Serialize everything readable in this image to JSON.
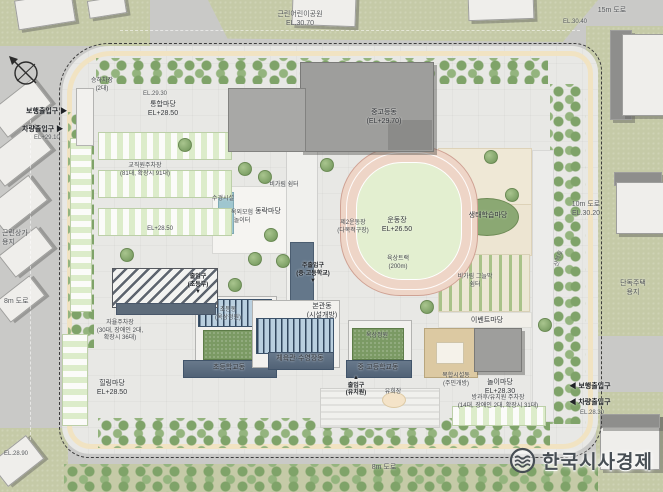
{
  "watermark": {
    "text": "한국시사경제",
    "icon": "waves-logo-icon",
    "color": "#474e54"
  },
  "compass": {
    "icon": "north-arrow-icon"
  },
  "palette": {
    "road": "#c9c9c7",
    "context_green": "#c5caa7",
    "site_paving": "#e8e8e5",
    "perimeter_path": "#f1e3c0",
    "track_ring": "#eed5c7",
    "track_infield": "#e3efd0",
    "pv_roof": "#b9cfdf",
    "building_band": "#5d6e80",
    "green_roof": "#7b9a64",
    "gym_gray": "#9e9e9c",
    "parking_green": "#dcecca",
    "boundary": "#3c3c3c"
  },
  "labels": [
    {
      "id": "neighborhood-park",
      "t": "근린어린이공원\nEL.30.70",
      "x": 300,
      "y": 11,
      "cls": "ctx"
    },
    {
      "id": "road-15m",
      "t": "15m 도로",
      "x": 612,
      "y": 7,
      "cls": "ctx"
    },
    {
      "id": "el-30-40",
      "t": "EL.30.40",
      "x": 575,
      "y": 19,
      "cls": "ctx tiny"
    },
    {
      "id": "el-29-30",
      "t": "EL.29.30",
      "x": 155,
      "y": 91,
      "cls": "ctx tiny"
    },
    {
      "id": "ped-entrance-west",
      "t": "보행출입구 ▶",
      "x": 26,
      "y": 108,
      "cls": "left b"
    },
    {
      "id": "veh-entrance-west",
      "t": "차량출입구 ▶",
      "x": 22,
      "y": 126,
      "cls": "left b"
    },
    {
      "id": "el-29-10",
      "t": "EL+29.10",
      "x": 34,
      "y": 135,
      "cls": "left tiny ctx"
    },
    {
      "id": "retail-site",
      "t": "근린상가\n용지",
      "x": 2,
      "y": 230,
      "cls": "left ctx"
    },
    {
      "id": "road-8m-west",
      "t": "8m 도로",
      "x": 4,
      "y": 298,
      "cls": "left ctx"
    },
    {
      "id": "road-10m-east",
      "t": "10m 도로\nEL.30.20",
      "x": 586,
      "y": 201,
      "cls": "ctx"
    },
    {
      "id": "walking-path",
      "t": "산책로",
      "x": 560,
      "y": 255,
      "cls": "tiny rot ctx"
    },
    {
      "id": "housing-site",
      "t": "단독주택용지",
      "x": 633,
      "y": 280,
      "cls": "ctx"
    },
    {
      "id": "ped-entrance-east",
      "t": "◀ 보행출입구",
      "x": 590,
      "y": 383,
      "cls": "b"
    },
    {
      "id": "veh-entrance-east",
      "t": "◀ 차량출입구",
      "x": 590,
      "y": 399,
      "cls": "b"
    },
    {
      "id": "el-28-30",
      "t": "EL.28.30",
      "x": 592,
      "y": 410,
      "cls": "tiny ctx"
    },
    {
      "id": "road-8m-south",
      "t": "8m 도로",
      "x": 384,
      "y": 464,
      "cls": "ctx"
    },
    {
      "id": "el-28-90",
      "t": "EL.28.90",
      "x": 16,
      "y": 451,
      "cls": "tiny ctx"
    },
    {
      "id": "unified-plaza",
      "t": "통합마당\nEL+28.50",
      "x": 163,
      "y": 101
    },
    {
      "id": "shuttle-dropoff",
      "t": "승하차장\n(2대)",
      "x": 102,
      "y": 78,
      "cls": "tiny"
    },
    {
      "id": "staff-parking",
      "t": "교직원주차장\n(81대, 확장시 91대)",
      "x": 145,
      "y": 163,
      "cls": "tiny"
    },
    {
      "id": "el-28-50-west",
      "t": "EL+28.50",
      "x": 160,
      "y": 226,
      "cls": "tiny"
    },
    {
      "id": "mid-high-building",
      "t": "중고등동\n(EL+29.70)",
      "x": 384,
      "y": 109
    },
    {
      "id": "sports-field",
      "t": "운동장\nEL+26.50",
      "x": 397,
      "y": 217
    },
    {
      "id": "running-track",
      "t": "육상트랙\n(200m)",
      "x": 398,
      "y": 256,
      "cls": "tiny"
    },
    {
      "id": "eco-learning-yard",
      "t": "생태학습마당",
      "x": 488,
      "y": 212
    },
    {
      "id": "dongnak-yard",
      "t": "동락마당",
      "x": 268,
      "y": 208
    },
    {
      "id": "water-feature",
      "t": "수경시설",
      "x": 223,
      "y": 196,
      "cls": "tiny"
    },
    {
      "id": "adventure-playground",
      "t": "옥외모험\n놀이터",
      "x": 242,
      "y": 210,
      "cls": "tiny"
    },
    {
      "id": "rain-shelter",
      "t": "비가림 쉼터",
      "x": 284,
      "y": 182,
      "cls": "tiny"
    },
    {
      "id": "second-field",
      "t": "제2운동장\n(다목적구장)",
      "x": 353,
      "y": 220,
      "cls": "tiny"
    },
    {
      "id": "main-entrance-midhigh",
      "t": "주출입구\n(중·고등학교)\n▼",
      "x": 313,
      "y": 263,
      "cls": "tiny b"
    },
    {
      "id": "entrance-elementary",
      "t": "출입구\n(초등부)\n▼",
      "x": 198,
      "y": 274,
      "cls": "tiny b"
    },
    {
      "id": "main-building",
      "t": "본관동\n(시설개방)",
      "x": 322,
      "y": 303
    },
    {
      "id": "elementary-roof-garden",
      "t": "초등동\n(옥상정원)",
      "x": 228,
      "y": 307,
      "cls": "tiny"
    },
    {
      "id": "roof-garden-east",
      "t": "옥상정원",
      "x": 377,
      "y": 333,
      "cls": "tiny"
    },
    {
      "id": "band-elementary",
      "t": "초등학교동",
      "x": 229,
      "y": 364,
      "cls": "band-t"
    },
    {
      "id": "band-gym-pool",
      "t": "체육관·수영장동",
      "x": 300,
      "y": 355,
      "cls": "band-t"
    },
    {
      "id": "band-midhigh",
      "t": "중·고등학교동",
      "x": 378,
      "y": 364,
      "cls": "band-t"
    },
    {
      "id": "self-parking",
      "t": "자율주차장\n(30대, 장애인 2대,\n확장시 36대)",
      "x": 120,
      "y": 320,
      "cls": "tiny"
    },
    {
      "id": "healing-yard",
      "t": "힐링마당\nEL+28.50",
      "x": 112,
      "y": 380
    },
    {
      "id": "entrance-kindergarten",
      "t": "▲\n출입구\n(유치원)",
      "x": 356,
      "y": 375,
      "cls": "tiny b"
    },
    {
      "id": "play-area",
      "t": "유희장",
      "x": 393,
      "y": 389,
      "cls": "tiny"
    },
    {
      "id": "community-building",
      "t": "복합시설동\n(주민개방)",
      "x": 456,
      "y": 373,
      "cls": "tiny"
    },
    {
      "id": "play-yard",
      "t": "놀이마당\nEL+28.30",
      "x": 500,
      "y": 379
    },
    {
      "id": "after-school-parking",
      "t": "방과후/유치원 주차장\n(14대, 장애인 2대, 확장시 31대)",
      "x": 498,
      "y": 395,
      "cls": "tiny"
    },
    {
      "id": "event-yard",
      "t": "이벤트마당",
      "x": 487,
      "y": 317
    },
    {
      "id": "pergola-shelter",
      "t": "비가림 그늘막\n쉼터",
      "x": 475,
      "y": 274,
      "cls": "tiny"
    }
  ]
}
